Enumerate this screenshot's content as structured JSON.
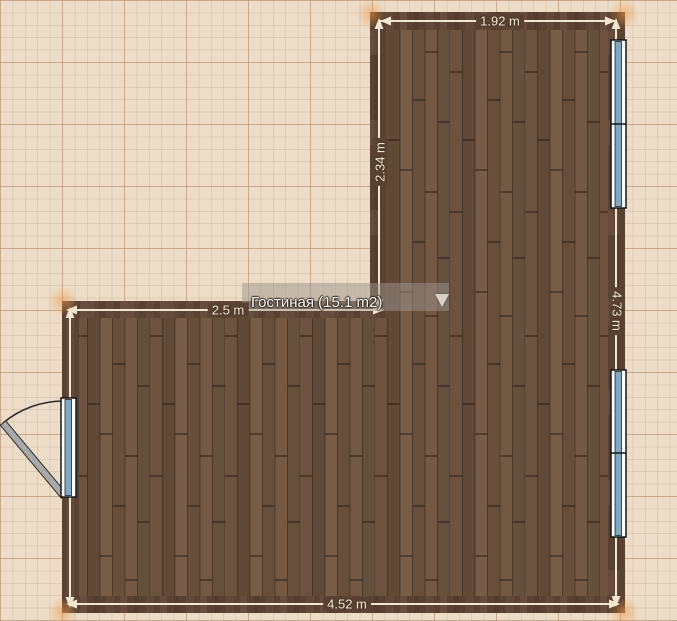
{
  "plan": {
    "room_label": "Гостиная (15.1 m2)",
    "dimensions": {
      "top": "1.92 m",
      "upper_left": "2.34 m",
      "right": "4.73 m",
      "middle": "2.5 m",
      "bottom": "4.52 m"
    }
  },
  "colors": {
    "background": "#EDDCC8",
    "wall": "#5A4233",
    "dimension": "#F2E6D2",
    "floor_base": "#6E5441",
    "window_glass": "#7FA8C3",
    "window_frame": "#FFFFFF",
    "door_leaf": "#A9A9A9"
  }
}
